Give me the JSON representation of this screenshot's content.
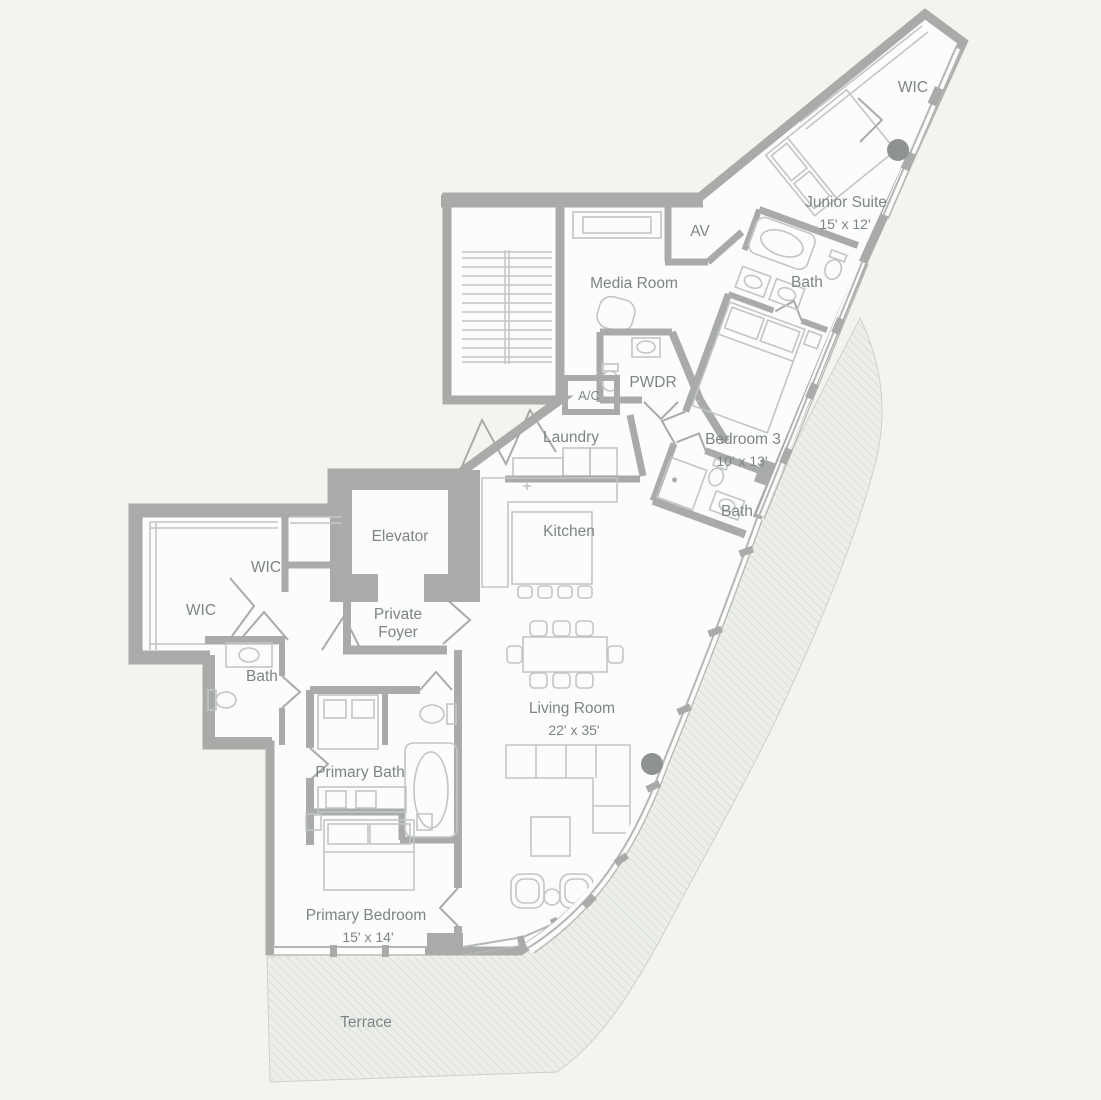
{
  "plan": {
    "rooms": {
      "wic_wing": {
        "label": "WIC"
      },
      "junior_suite": {
        "label": "Junior Suite",
        "dimensions": "15' x 12'"
      },
      "av": {
        "label": "AV"
      },
      "media_room": {
        "label": "Media Room"
      },
      "bath_junior": {
        "label": "Bath"
      },
      "pwdr": {
        "label": "PWDR"
      },
      "ac": {
        "label": "A/C"
      },
      "laundry": {
        "label": "Laundry"
      },
      "bedroom3": {
        "label": "Bedroom 3",
        "dimensions": "10' x 13'"
      },
      "bath_bedroom3": {
        "label": "Bath"
      },
      "elevator": {
        "label": "Elevator"
      },
      "kitchen": {
        "label": "Kitchen"
      },
      "wic_upper": {
        "label": "WIC"
      },
      "wic_lower": {
        "label": "WIC"
      },
      "private_foyer": {
        "line1": "Private",
        "line2": "Foyer"
      },
      "bath_left": {
        "label": "Bath"
      },
      "primary_bath": {
        "label": "Primary Bath"
      },
      "living_room": {
        "label": "Living Room",
        "dimensions": "22' x 35'"
      },
      "primary_bedroom": {
        "label": "Primary Bedroom",
        "dimensions": "15' x 14'"
      },
      "terrace": {
        "label": "Terrace"
      }
    },
    "colors": {
      "background": "#f4f3f0",
      "floor": "#fcfcfa",
      "wall": "#a8aba8",
      "furn": "#c2c6c3",
      "glass": "#b4b8b5",
      "text": "#7c8685",
      "column": "#8f938f",
      "hatchbg": "#eceeea",
      "hatchline": "#cdd1cd"
    }
  }
}
